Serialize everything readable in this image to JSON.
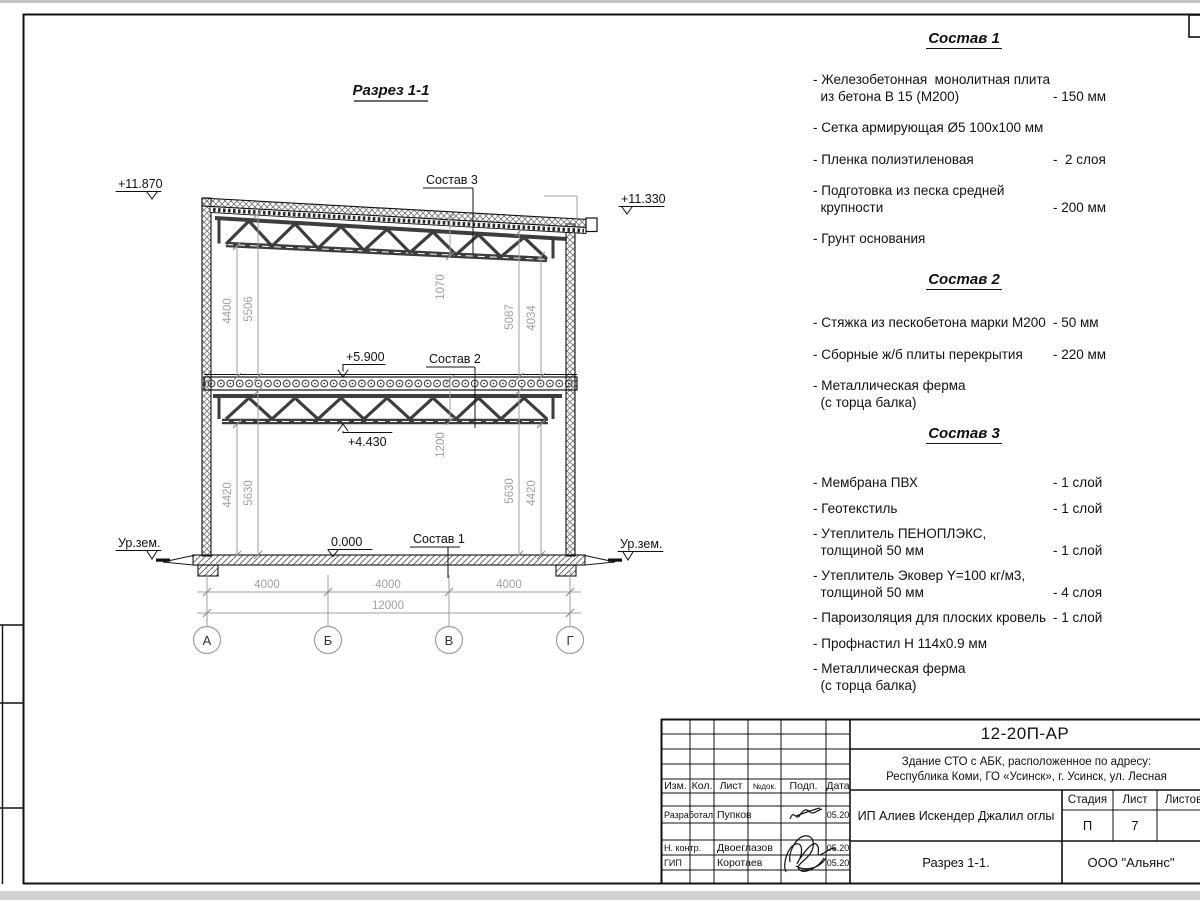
{
  "drawing": {
    "title": "Разрез 1-1",
    "elev": {
      "roof_left": "+11.870",
      "roof_right": "+11.330",
      "floor2": "+5.900",
      "truss": "+4.430",
      "zero": "0.000",
      "ground_left": "Ур.зем.",
      "ground_right": "Ур.зем."
    },
    "leaders": {
      "s3": "Состав 3",
      "s2": "Состав 2",
      "s1": "Состав 1"
    },
    "dims": {
      "ul1": "4400",
      "ul2": "5506",
      "um": "1070",
      "ur1": "5087",
      "ur2": "4034",
      "ll1": "4420",
      "ll2": "5630",
      "lm": "1200",
      "lr1": "5630",
      "lr2": "4420",
      "span1": "4000",
      "span2": "4000",
      "span3": "4000",
      "total": "12000"
    },
    "axes": {
      "a1": "А",
      "a2": "Б",
      "a3": "В",
      "a4": "Г"
    }
  },
  "lists": [
    {
      "title": "Состав 1",
      "items": [
        {
          "name": "- Железобетонная  монолитная плита\n  из бетона В 15 (М200)",
          "value": "- 150 мм"
        },
        {
          "name": "- Сетка армирующая Ø5 100х100 мм",
          "value": ""
        },
        {
          "name": "- Пленка полиэтиленовая",
          "value": "-  2 слоя"
        },
        {
          "name": "- Подготовка из песка средней\n  крупности",
          "value": "- 200 мм"
        },
        {
          "name": "- Грунт основания",
          "value": ""
        }
      ]
    },
    {
      "title": "Состав 2",
      "items": [
        {
          "name": "- Стяжка из пескобетона марки М200",
          "value": "- 50 мм"
        },
        {
          "name": "- Сборные ж/б плиты перекрытия",
          "value": "- 220 мм"
        },
        {
          "name": "- Металлическая ферма\n  (с торца балка)",
          "value": ""
        }
      ]
    },
    {
      "title": "Состав 3",
      "items": [
        {
          "name": "- Мембрана ПВХ",
          "value": "- 1 слой"
        },
        {
          "name": "- Геотекстиль",
          "value": "- 1 слой"
        },
        {
          "name": "- Утеплитель ПЕНОПЛЭКС,\n  толщиной 50 мм",
          "value": "- 1 слой"
        },
        {
          "name": "- Утеплитель Эковер Y=100 кг/м3,\n  толщиной 50 мм",
          "value": "- 4 слоя"
        },
        {
          "name": "- Пароизоляция для плоских кровель",
          "value": "- 1 слой"
        },
        {
          "name": "- Профнастил Н 114х0.9 мм",
          "value": ""
        },
        {
          "name": "- Металлическая ферма\n  (с торца балка)",
          "value": ""
        }
      ]
    }
  ],
  "titleblock": {
    "doc_number": "12-20П-АР",
    "project": "Здание СТО с АБК, расположенное по адресу:\nРеспублика Коми, ГО «Усинск», г. Усинск, ул. Лесная",
    "col_izm": "Изм.",
    "col_kol": "Кол.",
    "col_list": "Лист",
    "col_ndok": "№док.",
    "col_podp": "Подп.",
    "col_data": "Дата",
    "rows": [
      {
        "role": "Разработал",
        "name": "Пупков",
        "date": "05.20"
      },
      {
        "role": "Н. контр.",
        "name": "Двоеглазов",
        "date": "05.20"
      },
      {
        "role": "ГИП",
        "name": "Коротаев",
        "date": "05.20"
      }
    ],
    "client": "ИП Алиев Искендер Джалил оглы",
    "stage_label": "Стадия",
    "sheet_label": "Лист",
    "sheets_label": "Листов",
    "stage": "П",
    "sheet": "7",
    "sheets": "",
    "view_title": "Разрез 1-1.",
    "company": "ООО \"Альянс\""
  }
}
